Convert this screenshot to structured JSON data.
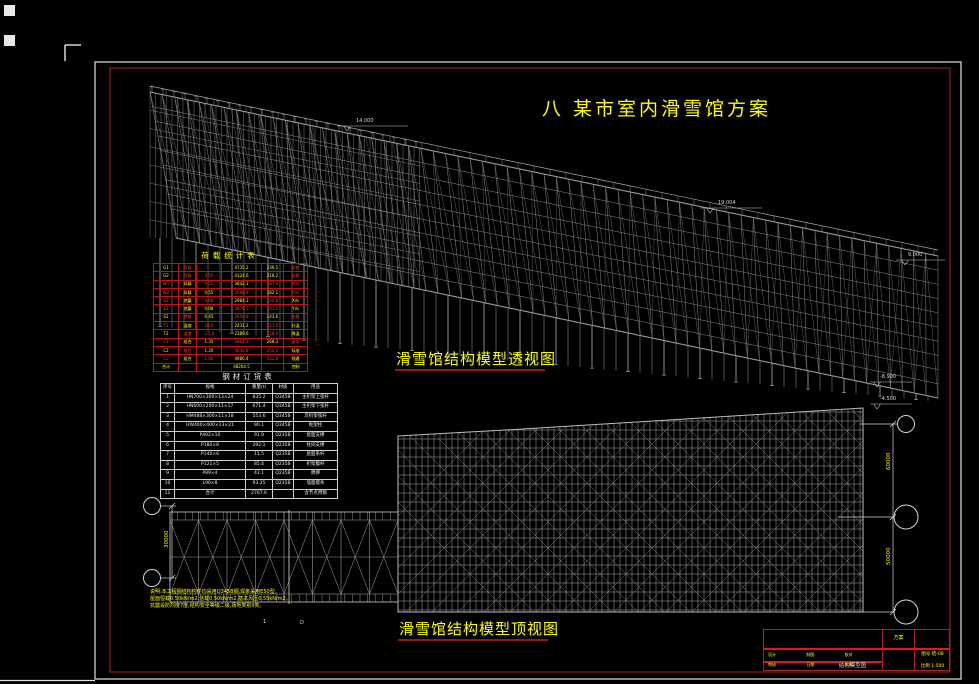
{
  "title": {
    "text": "八  某市室内滑雪馆方案"
  },
  "captions": {
    "perspective": "滑雪馆结构模型透视图",
    "top_view": "滑雪馆结构模型顶视图"
  },
  "load_table": {
    "title": "荷载统计表",
    "rows": [
      [
        "G1",
        "恒载",
        "",
        "4735.2",
        "236.5",
        "全楼"
      ],
      [
        "G2",
        "活载",
        "3.50",
        "4124.6",
        "218.2",
        "全楼"
      ],
      [
        "W1",
        "风载",
        "0.55",
        "3642.1",
        "187.4",
        "X向"
      ],
      [
        "W2",
        "风载",
        "0.55",
        "3598.4",
        "182.1",
        "Y向"
      ],
      [
        "E1",
        "地震",
        "0.08",
        "2984.3",
        "164.8",
        "X向"
      ],
      [
        "E2",
        "地震",
        "0.08",
        "2876.5",
        "161.2",
        "Y向"
      ],
      [
        "S1",
        "雪载",
        "0.45",
        "2654.8",
        "143.6",
        "全楼"
      ],
      [
        "T1",
        "温度",
        "25.0",
        "2431.2",
        "121.5",
        "升温"
      ],
      [
        "T2",
        "温度",
        "-25.0",
        "2389.6",
        "118.4",
        "降温"
      ],
      [
        "C1",
        "组合",
        "1.35",
        "5864.2",
        "268.3",
        "基本"
      ],
      [
        "C2",
        "组合",
        "1.20",
        "5642.8",
        "254.1",
        "标准"
      ],
      [
        "C3",
        "组合",
        "1.00",
        "4986.4",
        "232.6",
        "频遇"
      ],
      [
        "合计",
        "",
        "",
        "48264.5",
        "",
        "控制"
      ]
    ],
    "colors": [
      "yrryyr",
      "yrryyr",
      "ryryrr",
      "ryyryr",
      "ryryry",
      "ryyrry",
      "yryryr",
      "ryryry",
      "yrryry",
      "ryyryr",
      "yryrry",
      "ryryry",
      "yyyyyy"
    ]
  },
  "steel_table": {
    "title": "钢材订货表",
    "headers": [
      "序号",
      "规格",
      "重量(t)",
      "材质",
      "用途"
    ],
    "rows": [
      [
        "1",
        "HN700×300×13×24",
        "835.2",
        "Q345B",
        "主桁架上弦杆"
      ],
      [
        "2",
        "HN600×200×11×17",
        "671.4",
        "Q345B",
        "主桁架下弦杆"
      ],
      [
        "3",
        "HM488×300×11×18",
        "553.6",
        "Q345B",
        "次桁架弦杆"
      ],
      [
        "4",
        "HW400×400×13×21",
        "90.1",
        "Q345B",
        "框架柱"
      ],
      [
        "5",
        "P402×10",
        "91.9",
        "Q235B",
        "屋面支撑"
      ],
      [
        "6",
        "P180×8",
        "292.1",
        "Q235B",
        "柱间支撑"
      ],
      [
        "7",
        "P140×6",
        "11.5",
        "Q235B",
        "屋面系杆"
      ],
      [
        "8",
        "P121×5",
        "85.4",
        "Q235B",
        "桁架腹杆"
      ],
      [
        "9",
        "P89×4",
        "43.1",
        "Q235B",
        "隅撑"
      ],
      [
        "10",
        "L90×8",
        "93.25",
        "Q235B",
        "墙面檩条"
      ]
    ],
    "total_row": [
      "11",
      "合计",
      "2767.6",
      "",
      "含节点用钢"
    ]
  },
  "elevations": [
    {
      "text": "14.000"
    },
    {
      "text": "19.004"
    },
    {
      "text": "9.000"
    },
    {
      "text": "-8.900"
    },
    {
      "text": "-4.500"
    }
  ],
  "dimensions": {
    "left": "30000",
    "right_upper": "60000",
    "right_lower": "50000"
  },
  "axis_labels": [
    {
      "text": "1"
    },
    {
      "text": "D"
    }
  ],
  "notes": {
    "lines": [
      "说明:本工程钢结构构件均采用Q345B钢,焊条采用E50型。",
      "屋面恒载0.50kN/m2,活载0.50kN/m2,基本风压0.55kN/m2。",
      "抗震设防烈度7度,结构安全等级二级,场地类别II类。"
    ]
  },
  "titleblock": {
    "stage": "方案",
    "name": "结构模型图",
    "number_label": "图号",
    "number": "结-08",
    "scale_label": "比例",
    "scale": "1:500",
    "fields": [
      "设计",
      "制图",
      "校对",
      "审核",
      "日期",
      "工号"
    ]
  },
  "colors": {
    "accent_yellow": "#ffff00",
    "accent_red": "#e01818",
    "structure_gray": "#9b9b9b"
  }
}
